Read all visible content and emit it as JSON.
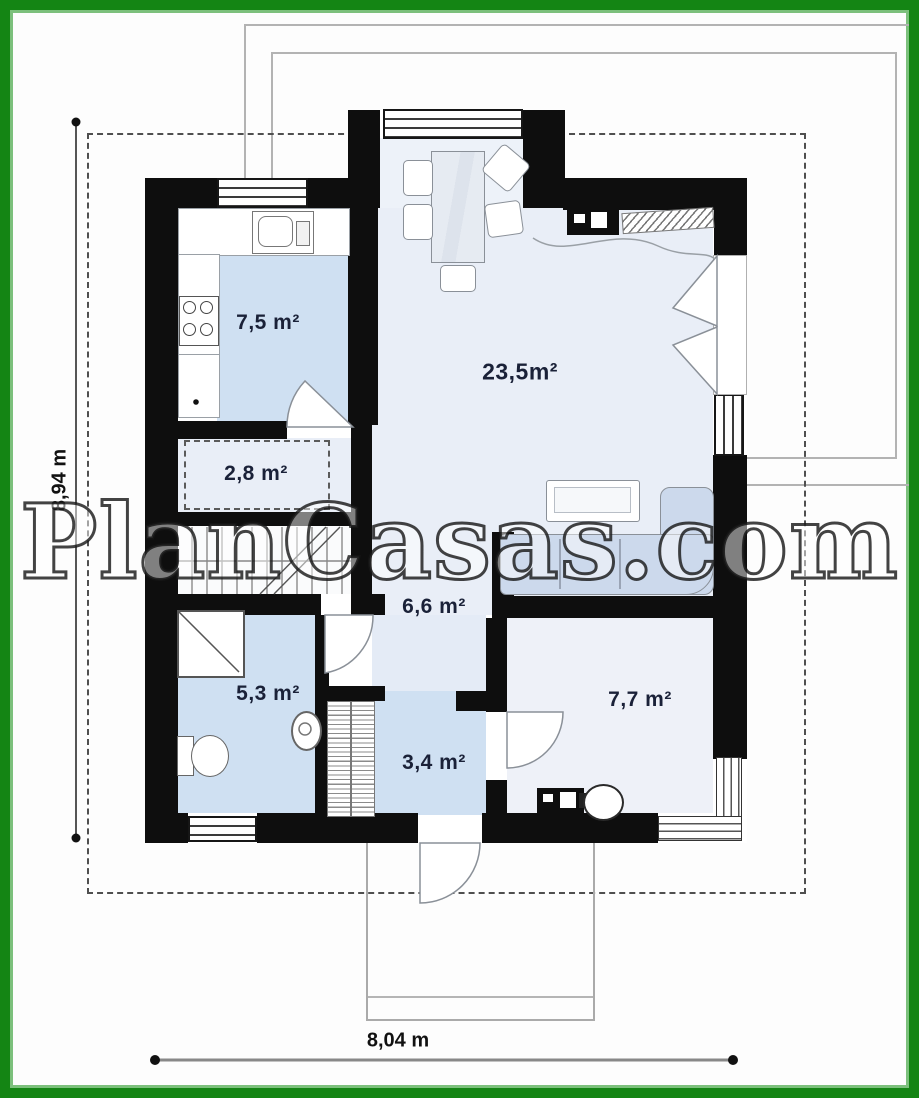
{
  "watermark": {
    "text": "PlanCasas.com"
  },
  "dimensions": {
    "vertical_label": "8,94 m",
    "horizontal_label": "8,04 m"
  },
  "rooms": [
    {
      "name": "kitchen",
      "area": "7,5 m²"
    },
    {
      "name": "living-dining",
      "area": "23,5m²"
    },
    {
      "name": "storage",
      "area": "2,8 m²"
    },
    {
      "name": "hall",
      "area": "6,6 m²"
    },
    {
      "name": "bathroom",
      "area": "5,3 m²"
    },
    {
      "name": "entry",
      "area": "3,4 m²"
    },
    {
      "name": "bedroom",
      "area": "7,7 m²"
    }
  ],
  "icons": [
    "entrance-arrow-icon",
    "stairs-icon",
    "shower-icon",
    "toilet-icon",
    "sink-icon",
    "stove-icon",
    "kitchen-sink-icon",
    "sofa-icon",
    "dining-table-icon",
    "fireplace-icon",
    "radiator-icon",
    "washer-icon",
    "boiler-icon"
  ],
  "colors": {
    "frame": "#148514",
    "wall": "#0e0e0e",
    "floorblue": "#cfe0f2",
    "floorlight": "#e9eef7",
    "sofa": "#ccd9ec",
    "label": "#1a2138"
  }
}
